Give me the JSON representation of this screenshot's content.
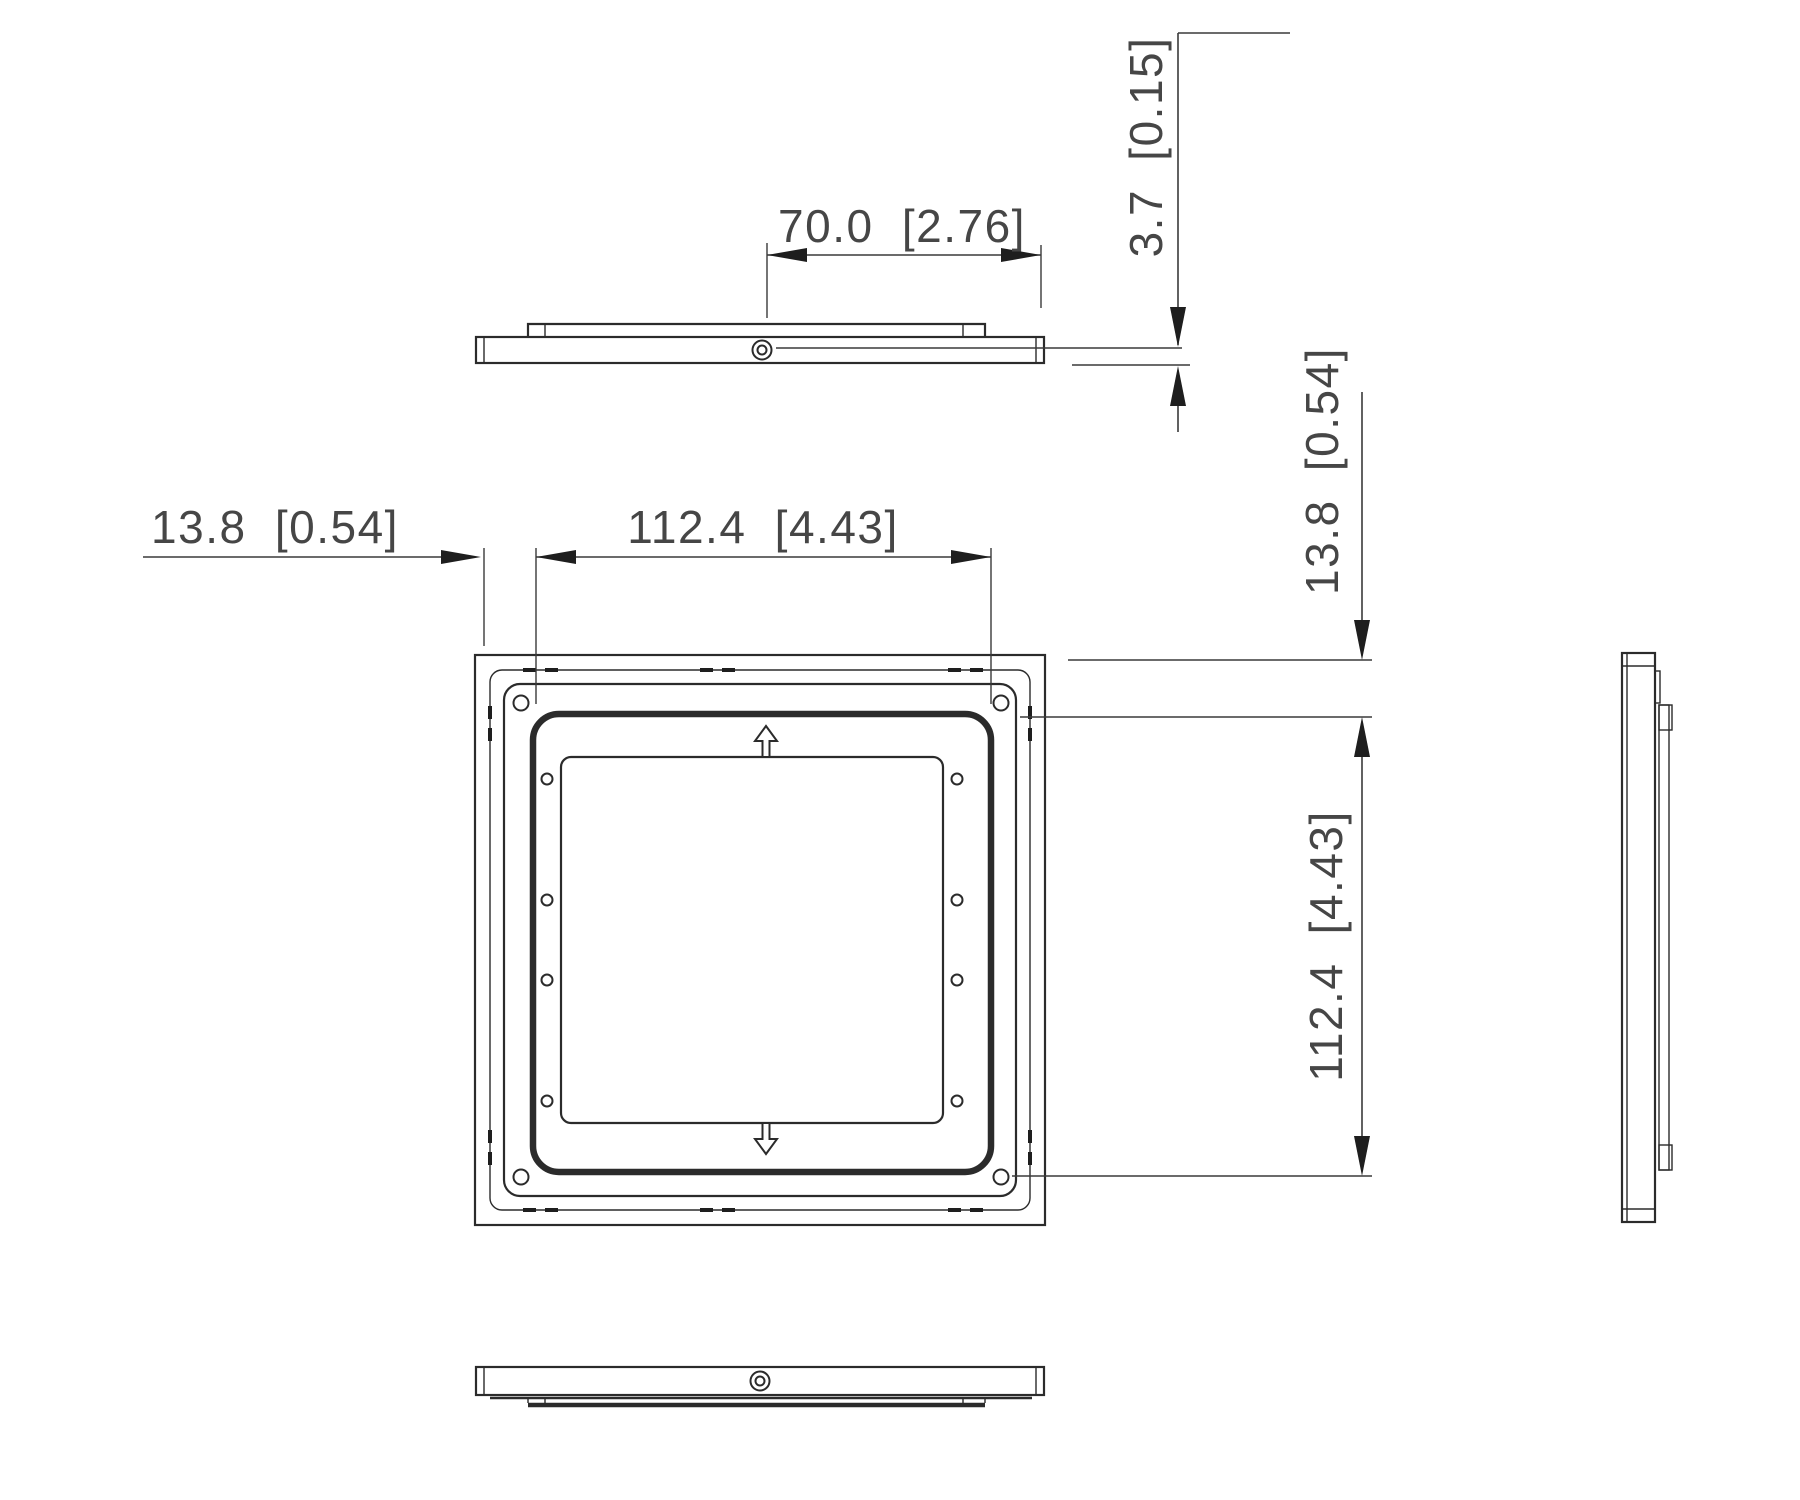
{
  "drawing": {
    "type": "technical-dimension-drawing",
    "part": "square adapter mounting plate",
    "views": {
      "top": "top profile view",
      "front": "front view",
      "side": "right side profile view",
      "bottom": "bottom profile view"
    },
    "dimensions": {
      "boss_width": "70.0 [2.76]",
      "thickness": "3.7 [0.15]",
      "edge_offset_left": "13.8 [0.54]",
      "edge_offset_right": "13.8 [0.54]",
      "pattern_width": "112.4 [4.43]",
      "pattern_height": "112.4 [4.43]"
    },
    "values_mm": {
      "boss_width": 70.0,
      "thickness": 3.7,
      "edge_offset": 13.8,
      "pattern_size": 112.4
    },
    "values_inch": {
      "boss_width": 2.76,
      "thickness": 0.15,
      "edge_offset": 0.54,
      "pattern_size": 4.43
    },
    "line_color": "#2b2b2b",
    "background_color": "#ffffff"
  }
}
